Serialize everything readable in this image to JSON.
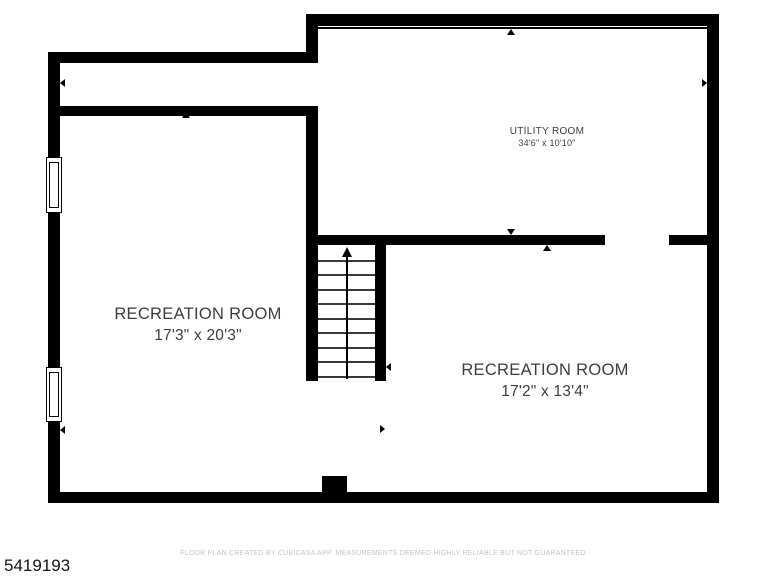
{
  "plan_id": "5419193",
  "footer": {
    "disclaimer": "FLOOR PLAN CREATED BY CUBICASA APP. MEASUREMENTS DEEMED HIGHLY RELIABLE BUT NOT GUARANTEED."
  },
  "colors": {
    "wall": "#000000",
    "room_label": "#3d3d3d",
    "disclaimer_text": "#c4c4c4",
    "plan_id_text": "#141414",
    "background": "#ffffff"
  },
  "rooms": [
    {
      "key": "utility-room",
      "name": "UTILITY ROOM",
      "dimensions": "34'6\" x 10'10\"",
      "cx": 547,
      "top": 126,
      "name_size": 10,
      "dim_size": 9,
      "gap": 1
    },
    {
      "key": "recreation-room-left",
      "name": "RECREATION ROOM",
      "dimensions": "17'3\" x 20'3\"",
      "cx": 198,
      "top": 305,
      "name_size": 16.5,
      "dim_size": 15.5,
      "gap": 3
    },
    {
      "key": "recreation-room-right",
      "name": "RECREATION ROOM",
      "dimensions": "17'2\" x 13'4\"",
      "cx": 545,
      "top": 361,
      "name_size": 16.5,
      "dim_size": 15.5,
      "gap": 3
    }
  ],
  "floorplan": {
    "walls": [
      {
        "name": "wall-left",
        "x": 48,
        "y": 52,
        "w": 12,
        "h": 451
      },
      {
        "name": "wall-top-left",
        "x": 48,
        "y": 52,
        "w": 270,
        "h": 11
      },
      {
        "name": "wall-step",
        "x": 306,
        "y": 14,
        "w": 12,
        "h": 49
      },
      {
        "name": "wall-top-right",
        "x": 306,
        "y": 14,
        "w": 413,
        "h": 12
      },
      {
        "name": "wall-right",
        "x": 707,
        "y": 14,
        "w": 12,
        "h": 489
      },
      {
        "name": "wall-bottom",
        "x": 48,
        "y": 492,
        "w": 671,
        "h": 11
      },
      {
        "name": "wall-interior-upper",
        "x": 48,
        "y": 106,
        "w": 270,
        "h": 10
      },
      {
        "name": "wall-stairs-west",
        "x": 306,
        "y": 106,
        "w": 12,
        "h": 275
      },
      {
        "name": "wall-utility-bottom-west",
        "x": 306,
        "y": 235,
        "w": 299,
        "h": 10
      },
      {
        "name": "wall-utility-bottom-east",
        "x": 669,
        "y": 235,
        "w": 50,
        "h": 10
      },
      {
        "name": "wall-stairs-east",
        "x": 375,
        "y": 245,
        "w": 11,
        "h": 136
      },
      {
        "name": "chimney-bump",
        "x": 322,
        "y": 476,
        "w": 25,
        "h": 16
      },
      {
        "name": "beam-line",
        "x": 318,
        "y": 27,
        "w": 389,
        "h": 2
      }
    ],
    "windows": [
      {
        "name": "window-left-upper",
        "x": 46,
        "y": 157,
        "w": 16,
        "h": 56
      },
      {
        "name": "window-left-lower",
        "x": 46,
        "y": 367,
        "w": 16,
        "h": 55
      }
    ],
    "stairs": {
      "name": "staircase",
      "x": 318,
      "y": 245,
      "w": 57,
      "h": 136,
      "tread_count": 9,
      "tread_spacing": 14.55,
      "center_line_offset": 28,
      "arrow": "up"
    },
    "markers": [
      {
        "name": "door-marker-left-upper",
        "dir": "left",
        "x": 60,
        "y": 83
      },
      {
        "name": "door-marker-interior-upper",
        "dir": "up",
        "x": 186,
        "y": 112
      },
      {
        "name": "door-marker-utility-top",
        "dir": "up",
        "x": 511,
        "y": 29
      },
      {
        "name": "door-marker-utility-right",
        "dir": "right",
        "x": 707,
        "y": 83
      },
      {
        "name": "door-marker-utility-bottom-north",
        "dir": "down",
        "x": 511,
        "y": 235
      },
      {
        "name": "door-marker-utility-bottom-south",
        "dir": "up",
        "x": 547,
        "y": 245
      },
      {
        "name": "door-marker-left-lower",
        "dir": "left",
        "x": 60,
        "y": 430
      },
      {
        "name": "door-marker-stairs-east",
        "dir": "left",
        "x": 386,
        "y": 367
      },
      {
        "name": "door-marker-rooms-boundary",
        "dir": "right",
        "x": 385,
        "y": 429
      }
    ]
  }
}
